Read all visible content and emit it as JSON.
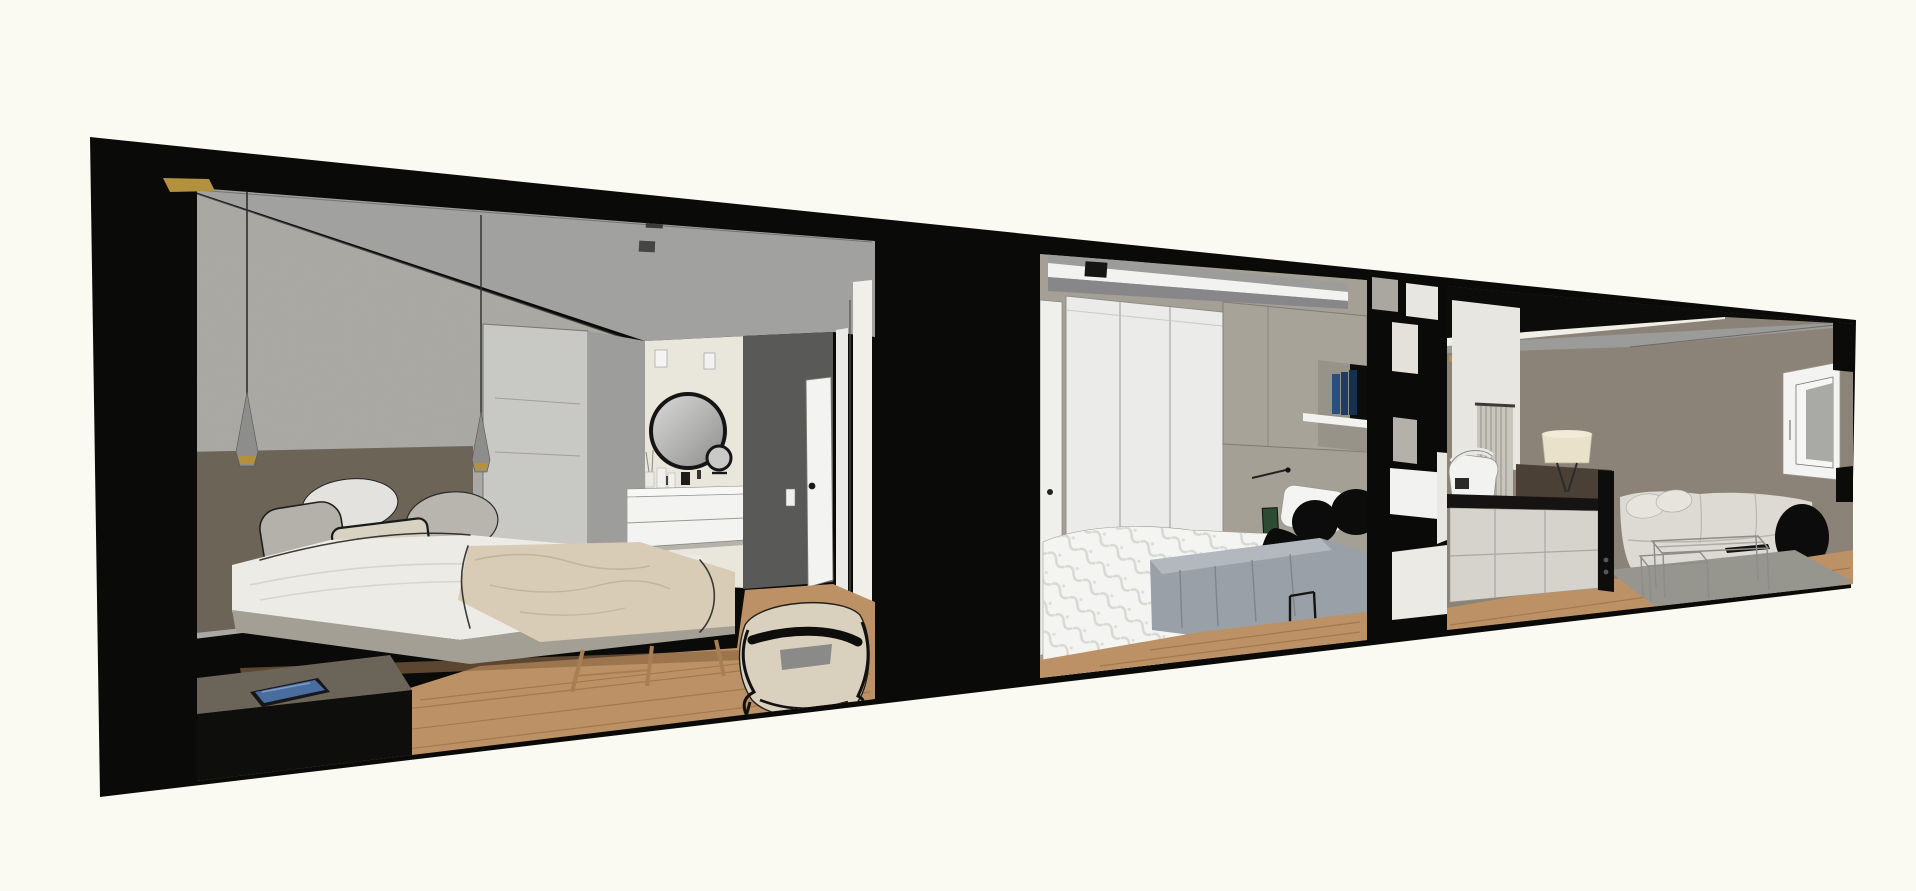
{
  "scene": {
    "title": "Apartment section cutaway 3D rendering",
    "style": "architectural sketch render, no visible text or UI controls",
    "rooms": [
      {
        "id": "master-bedroom",
        "label": "Master bedroom with ensuite bathroom",
        "objects": [
          "textured concrete feature wall",
          "gold ceiling accent",
          "two cone pendant lights with brass rings",
          "upholstered headboard panel",
          "double bed with white sheets and beige throw",
          "marble-pattern cushion",
          "grey cushions",
          "low dark media console with tablet",
          "wooden foot bench",
          "sketchy fabric basket chair",
          "round black-frame vanity mirror",
          "cosmetic mirror",
          "floating white vanity with bottles",
          "ceiling spotlights",
          "dark grey wall panel with switch",
          "white interior door",
          "glass wardrobe partition",
          "oak plank floor"
        ]
      },
      {
        "id": "second-bedroom",
        "label": "Second bedroom",
        "objects": [
          "white dropped ceiling box",
          "black ceiling spotlight",
          "white three-door wardrobe",
          "taupe overhead cabinets",
          "white shelf with blue books",
          "green wall art",
          "bed with white damask duvet",
          "black round cushions",
          "black draped throw",
          "grey pleated blanket",
          "black metal stand",
          "oak plank floor"
        ]
      },
      {
        "id": "kitchen-living",
        "label": "Kitchen and living room",
        "objects": [
          "black suspended ceiling panels with light slits",
          "black open shelving room divider",
          "kitchen island with black counter",
          "white food processor",
          "radiator slat panel",
          "dark wood sideboard",
          "drum-shade table lamp",
          "long light-grey sofa",
          "black bolster cushion",
          "wire nesting coffee tables",
          "grey area rug",
          "white casement window",
          "oak plank floor"
        ]
      }
    ],
    "palette": {
      "background": "#fbfaf2",
      "cut_black": "#0a0a09",
      "ceiling_grey": "#a1a19f",
      "wall_concrete": "#a9a8a3",
      "wall_headboard": "#6d6458",
      "bed_white": "#edebe6",
      "platform_grey": "#a39f94",
      "blanket_beige": "#d8ccb7",
      "wood_floor": "#bd9166",
      "wood_dark": "#8a6744",
      "bath_wall": "#e9e6db",
      "wall_dark": "#595957",
      "door_white": "#f3f3f1",
      "wardrobe_white": "#ebebe9",
      "cabinet_taupe": "#a8a399",
      "shelf_white": "#f2f2f0",
      "book_blue": "#27507e",
      "duvet_white": "#f4f4f2",
      "blanket_grey": "#9aa0a7",
      "cushion_black": "#0c0c0c",
      "wall_taupe": "#8b8377",
      "wall_taupe_light": "#a5a095",
      "sofa_light": "#dcdad3",
      "rug_grey": "#96958e",
      "island_base": "#d5d3cc",
      "counter_black": "#151413",
      "sideboard_wood": "#4a4036",
      "lamp_shade": "#eae1cb",
      "window_glass": "#a9a9a5",
      "glass_panel": "#e8e8e6",
      "brass": "#b3913f",
      "tablet_screen": "#4a6da0",
      "slat_panel": "#c8c5bc",
      "art_green": "#2e4a33",
      "pendant_grey": "#8d8d8b",
      "mirror_frame": "#151515",
      "basket_cream": "#d9d0bd"
    }
  }
}
